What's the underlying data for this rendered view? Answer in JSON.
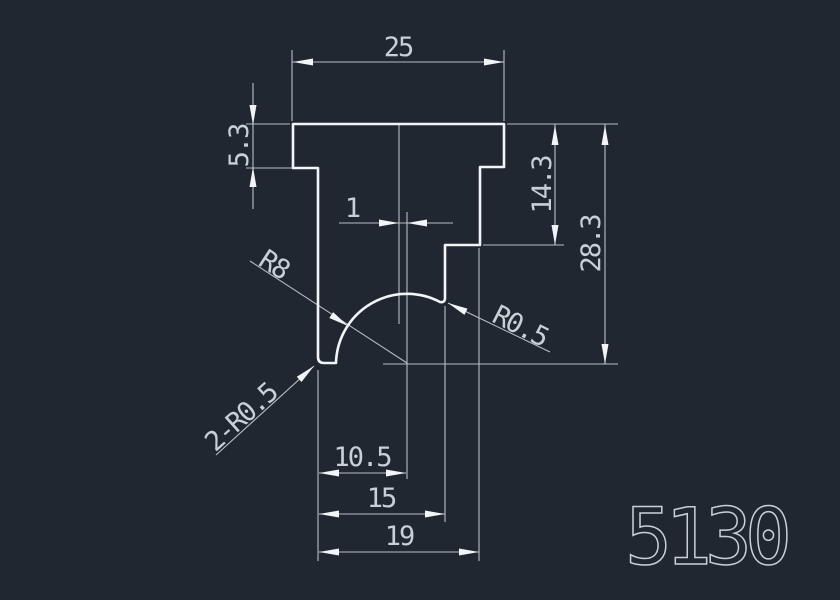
{
  "drawing": {
    "part_number": "5130",
    "colors": {
      "bg": "#212730",
      "line": "#b7bec6",
      "profile": "#f2f5f7",
      "text": "#c9cfd6"
    },
    "dimensions": {
      "top_width": "25",
      "flange_height": "5.3",
      "center_offset": "1",
      "right_step_depth": "14.3",
      "overall_height": "28.3",
      "bottom_width_1": "10.5",
      "bottom_width_2": "15",
      "bottom_width_3": "19",
      "radius_arc": "R8",
      "radius_fillet_right": "R0.5",
      "radius_fillet_left": "2-R0.5"
    }
  }
}
